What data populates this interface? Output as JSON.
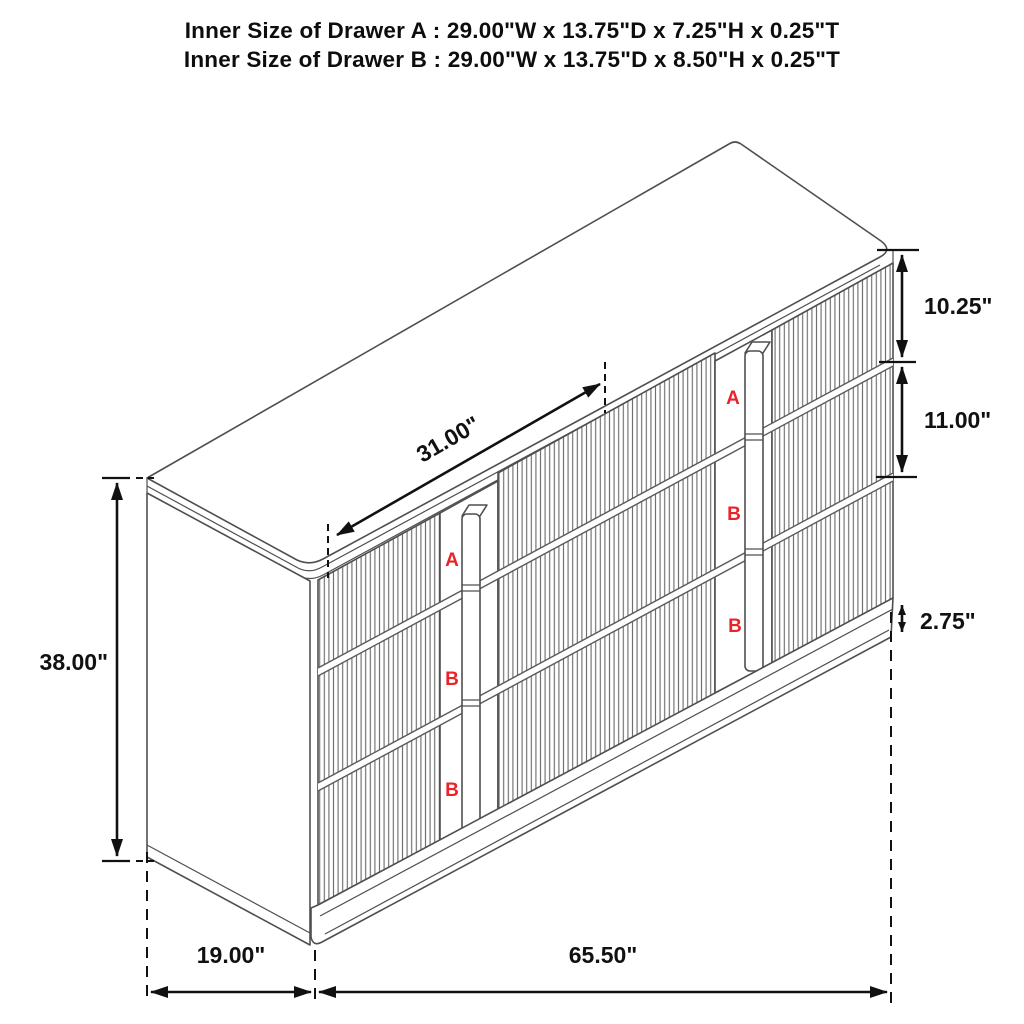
{
  "title": {
    "line1": "Inner Size of Drawer A : 29.00\"W x 13.75\"D x 7.25\"H x 0.25\"T",
    "line2": "Inner Size of Drawer B : 29.00\"W x 13.75\"D x 8.50\"H x 0.25\"T"
  },
  "dimensions": {
    "drawer_opening_width": "31.00\"",
    "drawer_a_front_height": "10.25\"",
    "drawer_b_front_height": "11.00\"",
    "base_height": "2.75\"",
    "overall_height": "38.00\"",
    "overall_depth": "19.00\"",
    "overall_width": "65.50\""
  },
  "drawer_labels": {
    "left_column": [
      "A",
      "B",
      "B"
    ],
    "right_column": [
      "A",
      "B",
      "B"
    ]
  },
  "colors": {
    "drawer_label_red": "#e8232a",
    "cabinet_line_gray": "#4f4f4f",
    "dimension_line_black": "#111111",
    "background": "#ffffff"
  }
}
